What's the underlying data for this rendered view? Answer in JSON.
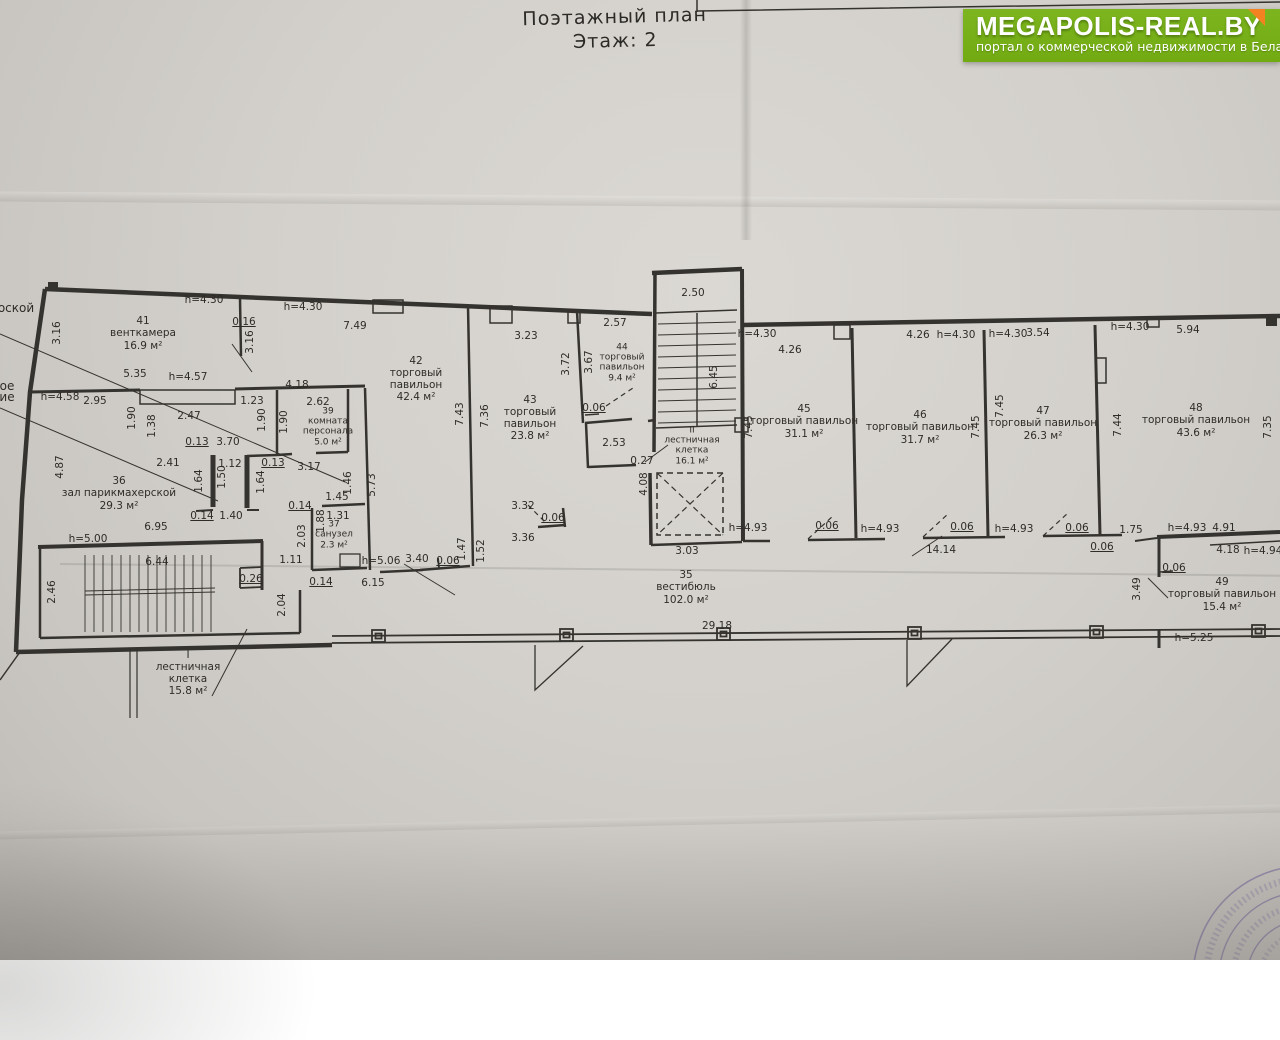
{
  "title": {
    "line1": "Поэтажный план",
    "line2": "Этаж: 2"
  },
  "logo": {
    "name": "MEGAPOLIS-REAL.BY",
    "tagline": "портал о коммерческой недвижимости в Беларуси",
    "bg_color": "#7cb51f",
    "corner_color": "#f58220"
  },
  "colors": {
    "paper": "#d2cfca",
    "ink": "#35332f",
    "stamp_purple": "#756a9e"
  },
  "plan": {
    "rooms": [
      {
        "number": "41",
        "name": "венткамера",
        "area": "16.9 м²",
        "x": 143,
        "y": 334,
        "w": 120
      },
      {
        "number": "36",
        "name": "зал парикмахерской",
        "area": "29.3 м²",
        "x": 119,
        "y": 494,
        "w": 150
      },
      {
        "number": "39",
        "name": "комната\nперсонала",
        "area": "5.0 м²",
        "x": 328,
        "y": 428,
        "w": 90,
        "s": 1
      },
      {
        "number": "37",
        "name": "санузел",
        "area": "2.3 м²",
        "x": 334,
        "y": 536,
        "w": 70,
        "s": 1
      },
      {
        "number": "42",
        "name": "торговый\nпавильон",
        "area": "42.4 м²",
        "x": 416,
        "y": 380,
        "w": 90
      },
      {
        "number": "43",
        "name": "торговый\nпавильон",
        "area": "23.8 м²",
        "x": 530,
        "y": 419,
        "w": 90
      },
      {
        "number": "44",
        "name": "торговый\nпавильон",
        "area": "9.4 м²",
        "x": 622,
        "y": 364,
        "w": 70,
        "s": 1
      },
      {
        "number": "45",
        "name": "торговый павильон",
        "area": "31.1 м²",
        "x": 804,
        "y": 422,
        "w": 170
      },
      {
        "number": "46",
        "name": "торговый павильон",
        "area": "31.7 м²",
        "x": 920,
        "y": 428,
        "w": 170
      },
      {
        "number": "47",
        "name": "торговый павильон",
        "area": "26.3 м²",
        "x": 1043,
        "y": 424,
        "w": 170
      },
      {
        "number": "48",
        "name": "торговый павильон",
        "area": "43.6 м²",
        "x": 1196,
        "y": 421,
        "w": 170
      },
      {
        "number": "49",
        "name": "торговый павильон",
        "area": "15.4 м²",
        "x": 1222,
        "y": 595,
        "w": 170
      },
      {
        "number": "35",
        "name": "вестибюль",
        "area": "102.0 м²",
        "x": 686,
        "y": 588,
        "w": 110
      },
      {
        "number": "I",
        "name": "лестничная\nклетка",
        "area": "15.8 м²",
        "x": 188,
        "y": 674,
        "w": 110
      },
      {
        "number": "II",
        "name": "лестничная\nклетка",
        "area": "16.1 м²",
        "x": 692,
        "y": 447,
        "w": 100,
        "s": 1
      }
    ],
    "dimensions": [
      {
        "t": "h=4.30",
        "x": 204,
        "y": 300
      },
      {
        "t": "0.16",
        "x": 244,
        "y": 322,
        "u": 1
      },
      {
        "t": "3.16",
        "x": 57,
        "y": 333,
        "v": 1
      },
      {
        "t": "3.16",
        "x": 250,
        "y": 342,
        "v": 1
      },
      {
        "t": "5.35",
        "x": 135,
        "y": 374
      },
      {
        "t": "h=4.57",
        "x": 188,
        "y": 377
      },
      {
        "t": "h=4.30",
        "x": 303,
        "y": 307
      },
      {
        "t": "7.49",
        "x": 355,
        "y": 326
      },
      {
        "t": "h=4.58",
        "x": 60,
        "y": 397
      },
      {
        "t": "2.95",
        "x": 95,
        "y": 401
      },
      {
        "t": "2.47",
        "x": 189,
        "y": 416
      },
      {
        "t": "1.23",
        "x": 252,
        "y": 401
      },
      {
        "t": "4.18",
        "x": 297,
        "y": 385
      },
      {
        "t": "1.90",
        "x": 132,
        "y": 418,
        "v": 1
      },
      {
        "t": "1.38",
        "x": 152,
        "y": 426,
        "v": 1
      },
      {
        "t": "1.90",
        "x": 262,
        "y": 420,
        "v": 1
      },
      {
        "t": "1.90",
        "x": 284,
        "y": 422,
        "v": 1
      },
      {
        "t": "2.62",
        "x": 318,
        "y": 402
      },
      {
        "t": "0.13",
        "x": 197,
        "y": 442,
        "u": 1
      },
      {
        "t": "3.70",
        "x": 228,
        "y": 442
      },
      {
        "t": "2.41",
        "x": 168,
        "y": 463
      },
      {
        "t": "1.12",
        "x": 230,
        "y": 464
      },
      {
        "t": "0.13",
        "x": 273,
        "y": 463,
        "u": 1
      },
      {
        "t": "3.17",
        "x": 309,
        "y": 467
      },
      {
        "t": "1.64",
        "x": 199,
        "y": 481,
        "v": 1
      },
      {
        "t": "1.50",
        "x": 222,
        "y": 477,
        "v": 1
      },
      {
        "t": "1.64",
        "x": 261,
        "y": 482,
        "v": 1
      },
      {
        "t": "4.87",
        "x": 60,
        "y": 467,
        "v": 1
      },
      {
        "t": "0.14",
        "x": 202,
        "y": 516,
        "u": 1
      },
      {
        "t": "1.40",
        "x": 231,
        "y": 516
      },
      {
        "t": "6.95",
        "x": 156,
        "y": 527
      },
      {
        "t": "h=5.00",
        "x": 88,
        "y": 539
      },
      {
        "t": "2.46",
        "x": 52,
        "y": 592,
        "v": 1
      },
      {
        "t": "6.44",
        "x": 157,
        "y": 562
      },
      {
        "t": "0.26",
        "x": 251,
        "y": 579,
        "u": 1
      },
      {
        "t": "2.04",
        "x": 282,
        "y": 605,
        "v": 1
      },
      {
        "t": "1.46",
        "x": 348,
        "y": 483,
        "v": 1
      },
      {
        "t": "5.73",
        "x": 372,
        "y": 485,
        "v": 1
      },
      {
        "t": "1.45",
        "x": 337,
        "y": 497
      },
      {
        "t": "0.14",
        "x": 300,
        "y": 506,
        "u": 1
      },
      {
        "t": "1.88",
        "x": 321,
        "y": 521,
        "v": 1
      },
      {
        "t": "1.31",
        "x": 338,
        "y": 516
      },
      {
        "t": "2.03",
        "x": 302,
        "y": 536,
        "v": 1
      },
      {
        "t": "1.11",
        "x": 291,
        "y": 560
      },
      {
        "t": "0.14",
        "x": 321,
        "y": 582,
        "u": 1
      },
      {
        "t": "6.15",
        "x": 373,
        "y": 583
      },
      {
        "t": "h=5.06",
        "x": 381,
        "y": 561
      },
      {
        "t": "3.40",
        "x": 417,
        "y": 559
      },
      {
        "t": "0.06",
        "x": 448,
        "y": 561,
        "u": 1
      },
      {
        "t": "1.47",
        "x": 462,
        "y": 549,
        "v": 1
      },
      {
        "t": "1.52",
        "x": 481,
        "y": 551,
        "v": 1
      },
      {
        "t": "3.32",
        "x": 523,
        "y": 506
      },
      {
        "t": "3.36",
        "x": 523,
        "y": 538
      },
      {
        "t": "0.06",
        "x": 553,
        "y": 518,
        "u": 1
      },
      {
        "t": "3.23",
        "x": 526,
        "y": 336
      },
      {
        "t": "2.57",
        "x": 615,
        "y": 323
      },
      {
        "t": "3.72",
        "x": 566,
        "y": 364,
        "v": 1
      },
      {
        "t": "3.67",
        "x": 589,
        "y": 362,
        "v": 1
      },
      {
        "t": "7.43",
        "x": 460,
        "y": 414,
        "v": 1
      },
      {
        "t": "7.36",
        "x": 485,
        "y": 416,
        "v": 1
      },
      {
        "t": "0.06",
        "x": 594,
        "y": 408,
        "u": 1
      },
      {
        "t": "2.53",
        "x": 614,
        "y": 443
      },
      {
        "t": "2.50",
        "x": 693,
        "y": 293
      },
      {
        "t": "6.45",
        "x": 714,
        "y": 377,
        "v": 1
      },
      {
        "t": "0.27",
        "x": 642,
        "y": 461
      },
      {
        "t": "4.08",
        "x": 644,
        "y": 484,
        "v": 1
      },
      {
        "t": "3.03",
        "x": 687,
        "y": 551
      },
      {
        "t": "h=4.30",
        "x": 757,
        "y": 334
      },
      {
        "t": "4.26",
        "x": 790,
        "y": 350
      },
      {
        "t": "4.26",
        "x": 918,
        "y": 335
      },
      {
        "t": "h=4.30",
        "x": 956,
        "y": 335
      },
      {
        "t": "h=4.30",
        "x": 1008,
        "y": 334
      },
      {
        "t": "3.54",
        "x": 1038,
        "y": 333
      },
      {
        "t": "h=4.30",
        "x": 1130,
        "y": 327
      },
      {
        "t": "5.94",
        "x": 1188,
        "y": 330
      },
      {
        "t": "7.45",
        "x": 749,
        "y": 427,
        "v": 1
      },
      {
        "t": "7.45",
        "x": 976,
        "y": 427,
        "v": 1
      },
      {
        "t": "7.45",
        "x": 1000,
        "y": 406,
        "v": 1
      },
      {
        "t": "7.44",
        "x": 1118,
        "y": 425,
        "v": 1
      },
      {
        "t": "7.35",
        "x": 1268,
        "y": 427,
        "v": 1
      },
      {
        "t": "h=4.93",
        "x": 748,
        "y": 528
      },
      {
        "t": "0.06",
        "x": 827,
        "y": 526,
        "u": 1
      },
      {
        "t": "h=4.93",
        "x": 880,
        "y": 529
      },
      {
        "t": "0.06",
        "x": 962,
        "y": 527,
        "u": 1
      },
      {
        "t": "h=4.93",
        "x": 1014,
        "y": 529
      },
      {
        "t": "14.14",
        "x": 941,
        "y": 550
      },
      {
        "t": "0.06",
        "x": 1077,
        "y": 528,
        "u": 1
      },
      {
        "t": "0.06",
        "x": 1102,
        "y": 547,
        "u": 1
      },
      {
        "t": "1.75",
        "x": 1131,
        "y": 530
      },
      {
        "t": "h=4.93",
        "x": 1187,
        "y": 528
      },
      {
        "t": "4.91",
        "x": 1224,
        "y": 528
      },
      {
        "t": "4.18",
        "x": 1228,
        "y": 550
      },
      {
        "t": "h=4.94",
        "x": 1263,
        "y": 551
      },
      {
        "t": "0.06",
        "x": 1174,
        "y": 568,
        "u": 1
      },
      {
        "t": "3.49",
        "x": 1137,
        "y": 589,
        "v": 1
      },
      {
        "t": "h=5.25",
        "x": 1194,
        "y": 638
      },
      {
        "t": "29.18",
        "x": 717,
        "y": 626
      }
    ],
    "cutoff_labels": [
      {
        "t": "оской",
        "x": 16,
        "y": 308
      },
      {
        "t": "ое",
        "x": 7,
        "y": 386
      },
      {
        "t": "ие",
        "x": 7,
        "y": 397
      }
    ]
  }
}
